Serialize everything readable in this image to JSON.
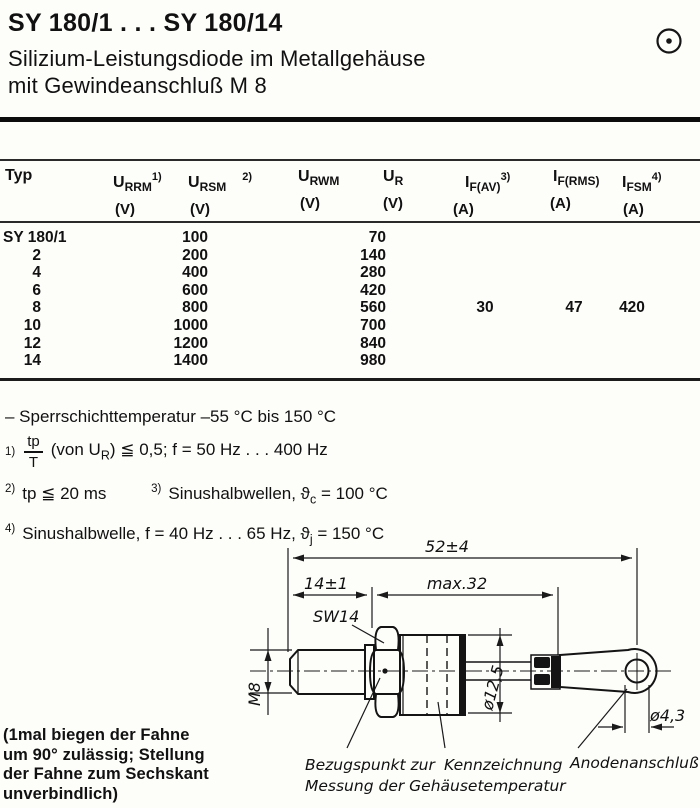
{
  "header": {
    "title": "SY 180/1 . . . SY 180/14",
    "subtitle_line1": "Silizium-Leistungsdiode im Metallgehäuse",
    "subtitle_line2": "mit Gewindeanschluß M 8",
    "mark_icon": "circle-dot-icon"
  },
  "table": {
    "headers": {
      "typ": "Typ",
      "urrm": {
        "base": "U",
        "sub": "RRM",
        "sup": "1)",
        "unit": "(V)"
      },
      "ursm": {
        "base": "U",
        "sub": "RSM",
        "sup": "2)",
        "unit": "(V)"
      },
      "urwm": {
        "base": "U",
        "sub": "RWM",
        "unit": "(V)"
      },
      "ur": {
        "base": "U",
        "sub": "R",
        "unit": "(V)"
      },
      "ifav": {
        "base": "I",
        "sub": "F(AV)",
        "sup": "3)",
        "unit": "(A)"
      },
      "ifrms": {
        "base": "I",
        "sub": "F(RMS)",
        "unit": "(A)"
      },
      "ifsm": {
        "base": "I",
        "sub": "FSM",
        "sup": "4)",
        "unit": "(A)"
      }
    },
    "rows": [
      {
        "typ": "SY 180/1",
        "u": "100",
        "urwm": "70"
      },
      {
        "typ": "2",
        "u": "200",
        "urwm": "140"
      },
      {
        "typ": "4",
        "u": "400",
        "urwm": "280"
      },
      {
        "typ": "6",
        "u": "600",
        "urwm": "420"
      },
      {
        "typ": "8",
        "u": "800",
        "urwm": "560",
        "ifav": "30",
        "ifrms": "47",
        "ifsm": "420"
      },
      {
        "typ": "10",
        "u": "1000",
        "urwm": "700"
      },
      {
        "typ": "12",
        "u": "1200",
        "urwm": "840"
      },
      {
        "typ": "14",
        "u": "1400",
        "urwm": "980"
      }
    ]
  },
  "notes": {
    "temp_range": "– Sperrschichttemperatur –55 °C bis 150 °C",
    "n1": {
      "marker": "1)",
      "frac_num": "tp",
      "frac_den": "T",
      "pre": "(von U",
      "sub": "R",
      "post": ") ≦ 0,5; f = 50 Hz . . . 400 Hz"
    },
    "n2": {
      "marker": "2)",
      "text": "tp ≦ 20 ms"
    },
    "n3": {
      "marker": "3)",
      "pre": "Sinushalbwellen,  ϑ",
      "sub": "c",
      "post": " = 100 °C"
    },
    "n4": {
      "marker": "4)",
      "pre": "Sinushalbwelle, f = 40 Hz . . . 65 Hz,  ϑ",
      "sub": "j",
      "post": " = 150 °C"
    }
  },
  "drawing": {
    "dim_total": "52±4",
    "dim_thread": "14±1",
    "dim_body": "max.32",
    "hex_size": "SW14",
    "thread_size": "M8",
    "body_dia": "ø12,5",
    "hole_dia": "ø4,3",
    "label_ref_1": "Bezugspunkt zur",
    "label_ref_2": "Messung der Gehäusetemperatur",
    "label_marking": "Kennzeichnung",
    "label_anode": "Anodenanschluß"
  },
  "flag_note": "(1mal biegen der Fahne\num 90° zulässig; Stellung\nder Fahne zum Sechskant\nunverbindlich)"
}
